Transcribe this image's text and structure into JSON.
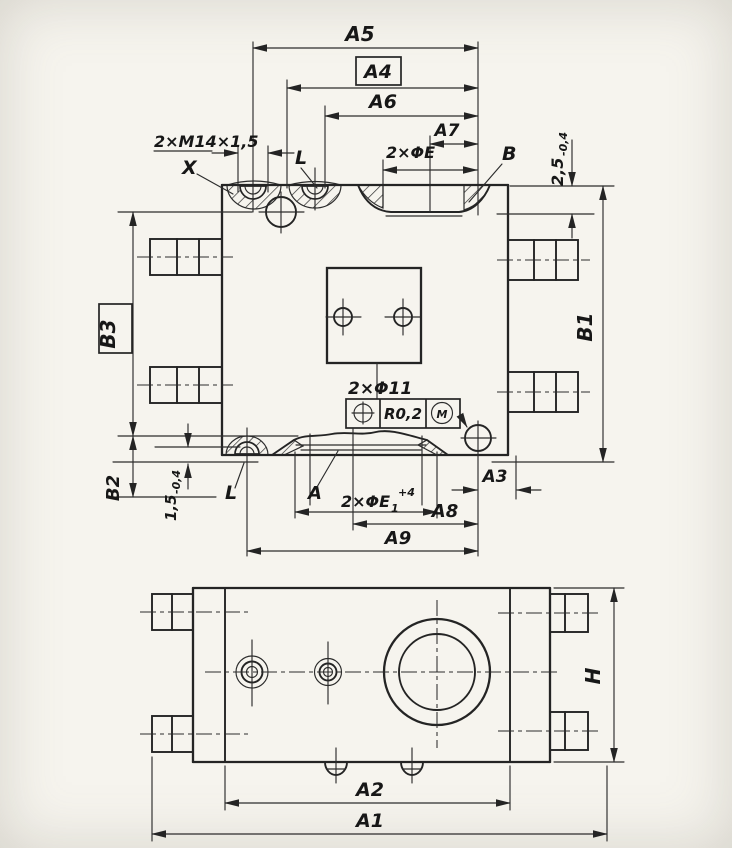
{
  "drawing": {
    "colors": {
      "ink": "#242424",
      "paper": "#f6f4ee"
    },
    "main_view": {
      "dim_a5": "A5",
      "dim_a4": "A4",
      "dim_a6": "A6",
      "dim_a7": "A7",
      "thread_callout": "2×M14×1,5",
      "section_x": "X",
      "section_l_top": "L",
      "hole_callout_top": "2×ΦE",
      "label_b": "B",
      "depth_top_value": "2,5",
      "depth_top_tol": "-0,4",
      "dim_b1": "B1",
      "dim_b3": "B3",
      "dim_b2": "B2",
      "depth_bottom_value": "1,5",
      "depth_bottom_tol": "-0,4",
      "section_l_bottom": "L",
      "label_a": "A",
      "hole_callout_bottom_base": "2×ΦE",
      "hole_callout_bottom_sub": "1",
      "hole_callout_bottom_sup": "+4",
      "hole_callout_center": "2×Φ11",
      "fcf_tolerance": "R0,2",
      "fcf_modifier": "M",
      "dim_a8": "A8",
      "dim_a9": "A9",
      "dim_a3": "A3"
    },
    "bottom_view": {
      "dim_a2": "A2",
      "dim_a1": "A1",
      "dim_h": "H"
    }
  }
}
